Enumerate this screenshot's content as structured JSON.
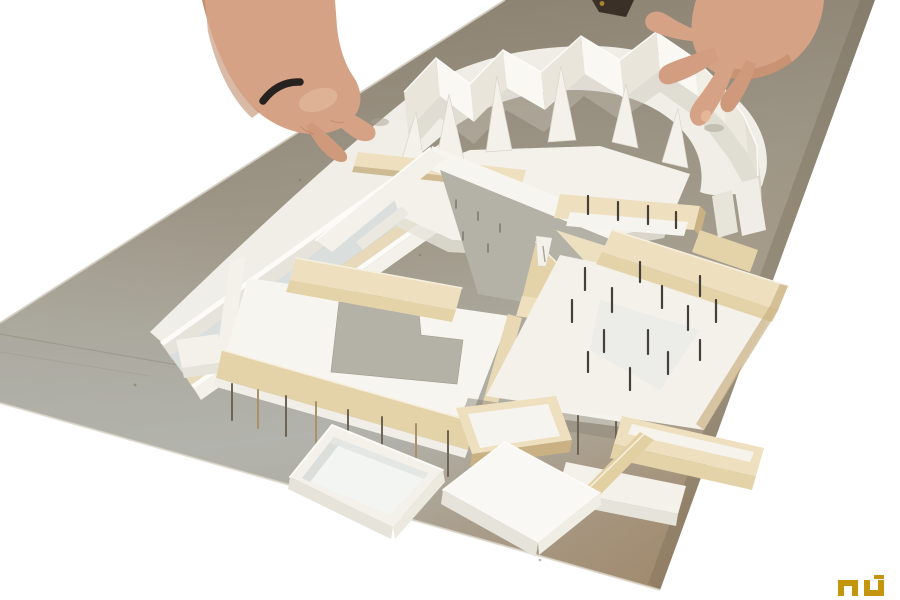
{
  "scene": {
    "type": "photograph",
    "subject": "architectural-scale-model-with-hands",
    "description": "Two hands adjust a white card and balsa-wood massing model of a building complex, mounted on a grey cardboard base, photographed against a white background."
  },
  "palette": {
    "bg": "#ffffff",
    "boardTop": "#8b8171",
    "boardMid": "#a39c8d",
    "boardLight": "#b2b3ac",
    "boardWarm": "#9b7d58",
    "boardEdgeDark": "#6e6250",
    "boardEdgeLight": "#d3cdc0",
    "cardWhite": "#f3f1ea",
    "cardBright": "#fcfbf8",
    "cardShadow": "#e6e3da",
    "cardCool": "#dadfde",
    "balsaLight": "#eee0bf",
    "balsaMid": "#e4d3a9",
    "balsaDark": "#c9b184",
    "balsaLip": "#f6efdd",
    "chipboard": "#b4b1a6",
    "pin": "#46403a",
    "stilt": "#6e6455",
    "shadowSoft": "#8e8678",
    "skin": "#d6a286",
    "skinShadow": "#b9825f",
    "skinLight": "#eccaa9",
    "ring": "#26221f",
    "logoGold": "#c6950e"
  },
  "watermark": {
    "text": "nu"
  }
}
